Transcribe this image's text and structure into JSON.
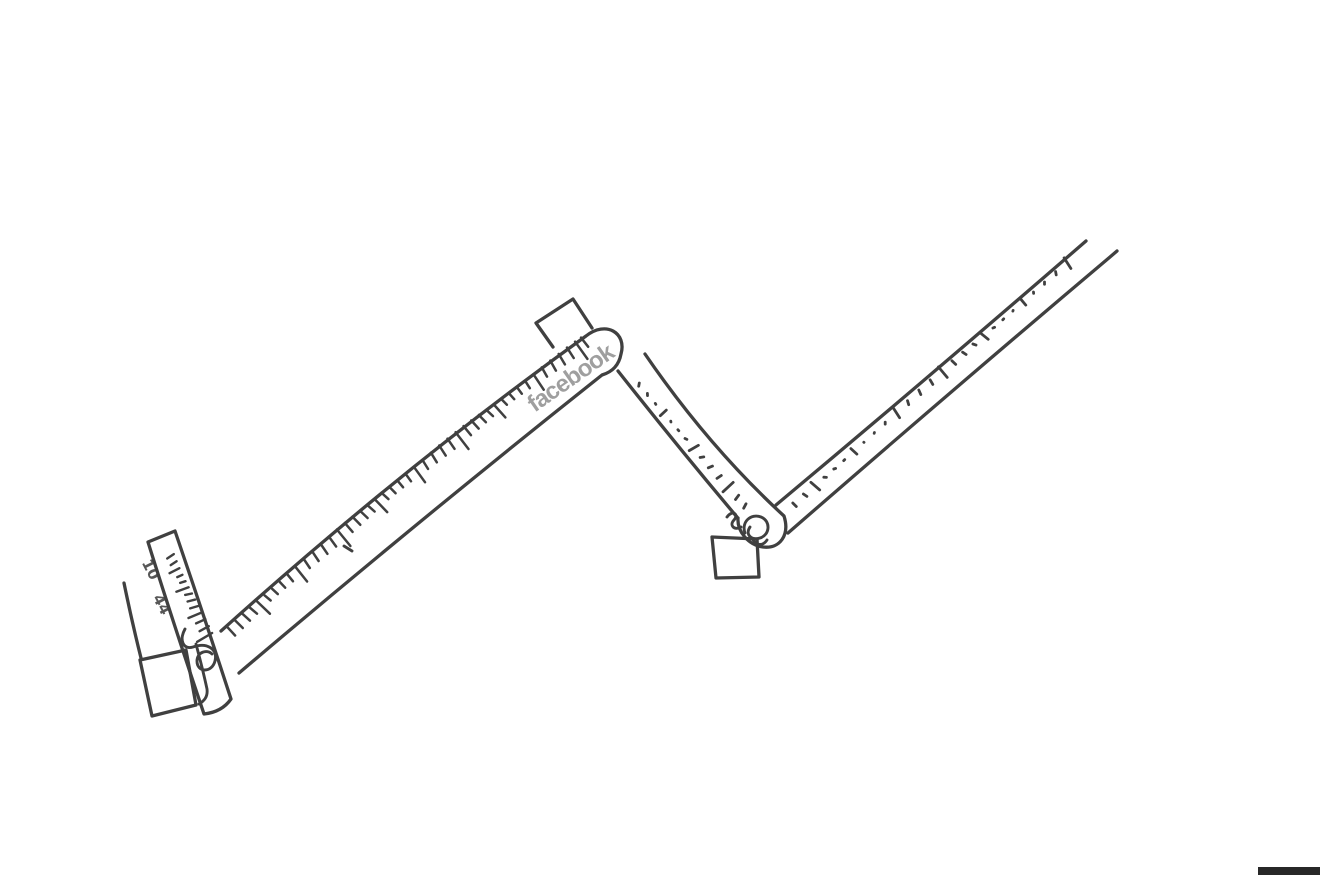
{
  "sketch": {
    "brand_label": "facebook",
    "ruler_numbers": {
      "first": "10",
      "second": "44"
    },
    "colors": {
      "ink": "#404040",
      "brand_gray": "#8f8f8f",
      "paper": "#ffffff",
      "scan_artifact": "#282828"
    }
  }
}
